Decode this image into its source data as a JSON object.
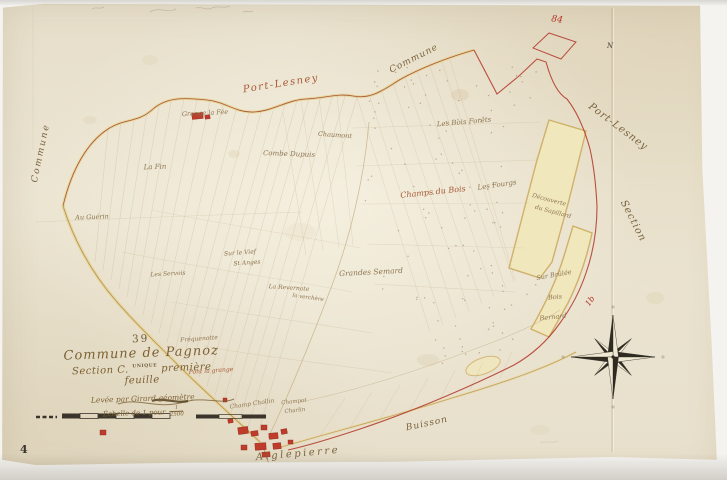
{
  "title_block": {
    "number": "39",
    "commune": "Commune de Pagnoz",
    "section_prefix": "Section C.",
    "unique_stamp": "UNIQUE",
    "section_suffix": "première feuille",
    "surveyor": "Levée par Girard géomètre",
    "scale_label": "Échelle de 1 pour",
    "scale_numerator": "1",
    "scale_value": "2500"
  },
  "page_number": "4",
  "colors": {
    "sep": "#7a643f",
    "ld": "#8d7550",
    "red": "#b33227",
    "red2": "#a85a38",
    "dark": "#443d30",
    "paper": "#e9e2cf",
    "road_yellow": "#e7d391",
    "wood_fill": "#f1e7bd",
    "wood_edge": "#cfb169",
    "line_faint": "#c6b28c"
  },
  "map_labels": [
    {
      "t": "Commune",
      "x": 41,
      "y": 153,
      "r": -78,
      "s": 9,
      "c": "sep",
      "ls": 2
    },
    {
      "t": "Port-Lesney",
      "x": 281,
      "y": 84,
      "r": -9,
      "s": 10,
      "c": "red2",
      "ls": 1.5
    },
    {
      "t": "Commune",
      "x": 414,
      "y": 59,
      "r": -27,
      "s": 9,
      "c": "sep",
      "ls": 1
    },
    {
      "t": "84",
      "x": 557,
      "y": 20,
      "r": 8,
      "s": 9,
      "c": "red"
    },
    {
      "t": "Port-Lesney",
      "x": 618,
      "y": 127,
      "r": 37,
      "s": 10,
      "c": "sep",
      "ls": 1
    },
    {
      "t": "Section",
      "x": 633,
      "y": 221,
      "r": 63,
      "s": 10,
      "c": "sep",
      "ls": 1
    },
    {
      "t": "N",
      "x": 610,
      "y": 46,
      "r": 0,
      "s": 7,
      "c": "dark"
    },
    {
      "t": "1b",
      "x": 590,
      "y": 301,
      "r": -55,
      "s": 8,
      "c": "red"
    },
    {
      "t": "Buisson",
      "x": 427,
      "y": 424,
      "r": -12,
      "s": 9,
      "c": "sep",
      "ls": 1
    },
    {
      "t": "Aiglepierre",
      "x": 298,
      "y": 454,
      "r": -5,
      "s": 10,
      "c": "sep",
      "ls": 2.5
    },
    {
      "t": "Grange la Fée",
      "x": 205,
      "y": 113,
      "r": -3,
      "s": 6.5,
      "c": "ld"
    },
    {
      "t": "Chaumont",
      "x": 335,
      "y": 135,
      "r": 4,
      "s": 6.5,
      "c": "ld"
    },
    {
      "t": "Combe Dupuis",
      "x": 289,
      "y": 154,
      "r": 2,
      "s": 7,
      "c": "ld"
    },
    {
      "t": "La Fin",
      "x": 155,
      "y": 167,
      "r": -2,
      "s": 7,
      "c": "ld"
    },
    {
      "t": "Au Guérin",
      "x": 92,
      "y": 217,
      "r": -2,
      "s": 6.5,
      "c": "ld"
    },
    {
      "t": "Les Bois Forêts",
      "x": 464,
      "y": 122,
      "r": -5,
      "s": 7,
      "c": "ld"
    },
    {
      "t": "Champs du Bois",
      "x": 433,
      "y": 192,
      "r": -6,
      "s": 8,
      "c": "red2"
    },
    {
      "t": "Les Fourgs",
      "x": 497,
      "y": 185,
      "r": -8,
      "s": 7,
      "c": "ld"
    },
    {
      "t": "Découverte",
      "x": 549,
      "y": 200,
      "r": 15,
      "s": 6,
      "c": "ld"
    },
    {
      "t": "du Sapillard",
      "x": 553,
      "y": 212,
      "r": 15,
      "s": 6,
      "c": "ld"
    },
    {
      "t": "Grandes Semard",
      "x": 371,
      "y": 272,
      "r": -3,
      "s": 7.5,
      "c": "ld"
    },
    {
      "t": "Sur le Vief",
      "x": 240,
      "y": 253,
      "r": -4,
      "s": 6,
      "c": "ld"
    },
    {
      "t": "St Anges",
      "x": 247,
      "y": 263,
      "r": -4,
      "s": 6,
      "c": "ld"
    },
    {
      "t": "Les Servois",
      "x": 168,
      "y": 274,
      "r": -3,
      "s": 6,
      "c": "ld"
    },
    {
      "t": "La Revernote",
      "x": 289,
      "y": 288,
      "r": 4,
      "s": 6,
      "c": "ld"
    },
    {
      "t": "la verchère",
      "x": 308,
      "y": 298,
      "r": 8,
      "s": 5.5,
      "c": "ld"
    },
    {
      "t": "Fréquenotte",
      "x": 199,
      "y": 339,
      "r": -4,
      "s": 6,
      "c": "ld"
    },
    {
      "t": "Pont la grange",
      "x": 211,
      "y": 371,
      "r": -4,
      "s": 6,
      "c": "red2"
    },
    {
      "t": "Champ Chollin",
      "x": 252,
      "y": 404,
      "r": -8,
      "s": 6,
      "c": "ld"
    },
    {
      "t": "Champot",
      "x": 294,
      "y": 402,
      "r": -6,
      "s": 5.5,
      "c": "ld"
    },
    {
      "t": "Charlin",
      "x": 295,
      "y": 411,
      "r": -6,
      "s": 5.5,
      "c": "ld"
    },
    {
      "t": "Sur Brûlée",
      "x": 554,
      "y": 275,
      "r": -10,
      "s": 6.5,
      "c": "ld"
    },
    {
      "t": "Bois",
      "x": 555,
      "y": 297,
      "r": -6,
      "s": 6.5,
      "c": "ld"
    },
    {
      "t": "Bernard",
      "x": 553,
      "y": 317,
      "r": -6,
      "s": 6.5,
      "c": "ld"
    }
  ]
}
